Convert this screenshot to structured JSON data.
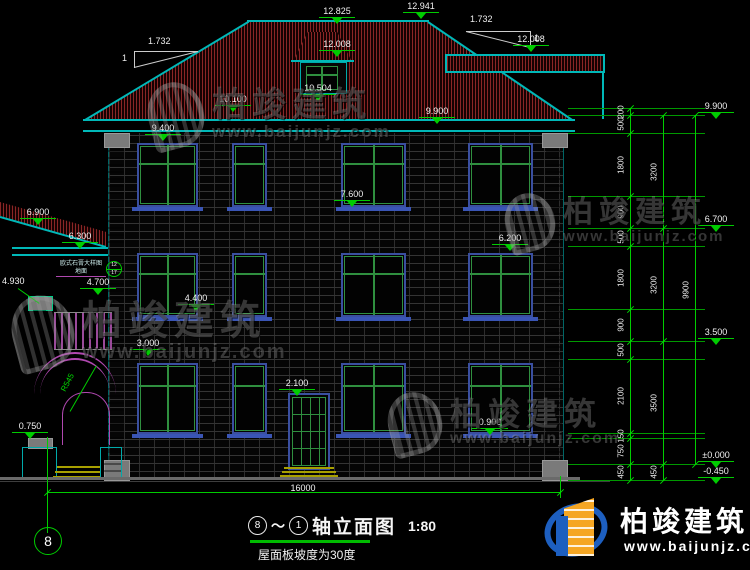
{
  "title": {
    "axis_start": "8",
    "tilde": "～",
    "axis_end": "1",
    "name": "轴立面图",
    "scale": "1:80",
    "note": "屋面板坡度为30度"
  },
  "axis_bubble": "8",
  "brand": {
    "name": "柏竣建筑",
    "url": "www.baijunjz.com"
  },
  "watermark": {
    "name": "柏竣建筑",
    "url": "www.baijunjz.com"
  },
  "slope": {
    "ratio": "1.732",
    "unit": "1"
  },
  "radius_label": "R545",
  "leader_label": "4.930",
  "callout": {
    "line1": "欧式石膏大样图",
    "line2": "地面",
    "detail_no": "12",
    "sheet_no": "17"
  },
  "markers": [
    "12.825",
    "12.941",
    "12.008",
    "12.008",
    "10.100",
    "10.504",
    "9.900",
    "9.400",
    "7.600",
    "6.200",
    "6.900",
    "6.300",
    "4.700",
    "4.400",
    "3.000",
    "2.100",
    "0.900",
    "0.750",
    "9.900",
    "6.700",
    "3.500",
    "±0.000",
    "-0.450"
  ],
  "dims": {
    "col1": [
      "200",
      "500",
      "1800",
      "900",
      "500",
      "1800",
      "900",
      "500",
      "2100",
      "150",
      "750",
      "450"
    ],
    "col2": [
      "3200",
      "3200",
      "3500",
      "450"
    ],
    "col3": [
      "9900"
    ],
    "bottom": "16000"
  }
}
